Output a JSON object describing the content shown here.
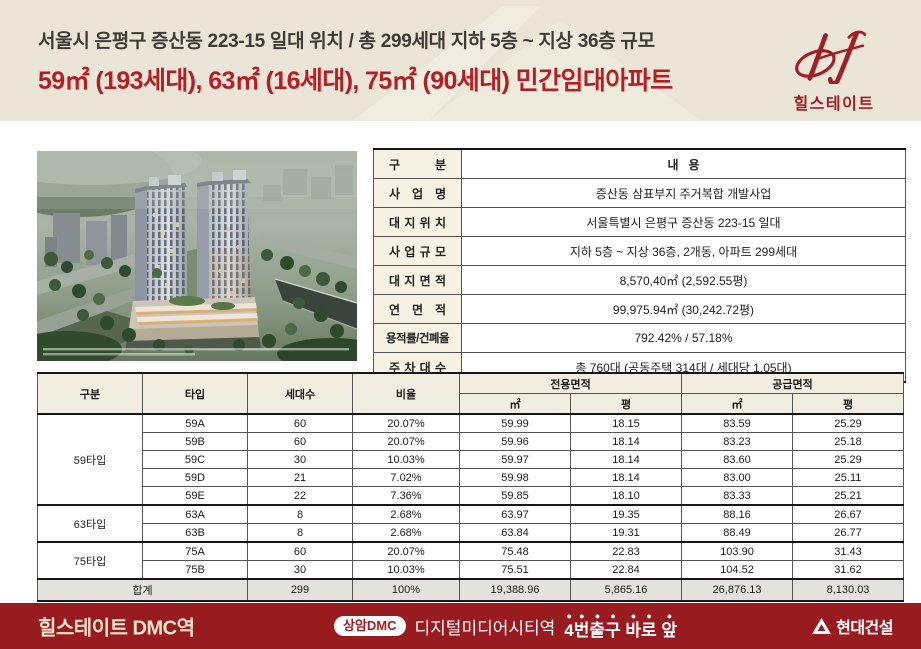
{
  "header": {
    "line1": "서울시 은평구 증산동 223-15 일대 위치 / 총 299세대 지하 5층 ~ 지상 36층 규모",
    "line2": "59㎡ (193세대), 63㎡ (16세대), 75㎡ (90세대) 민간임대아파트",
    "bg_color": "#eae5d6",
    "accent_color": "#b21f24"
  },
  "logo": {
    "brand": "힐스테이트",
    "color": "#9e2025"
  },
  "info_table": {
    "header_label": "구 분",
    "header_value": "내   용",
    "rows": [
      {
        "label": "사 업 명",
        "value": "증산동 삼표부지 주거복합 개발사업"
      },
      {
        "label": "대 지 위 치",
        "value": "서울특별시 은평구 증산동 223-15 일대"
      },
      {
        "label": "사 업 규 모",
        "value": "지하 5층 ~ 지상 36층, 2개동, 아파트 299세대"
      },
      {
        "label": "대 지 면 적",
        "value": "8,570,40㎡ (2,592.55평)"
      },
      {
        "label": "연 면 적",
        "value": "99,975.94㎡ (30,242.72평)"
      },
      {
        "label": "용적률/건폐율",
        "value": "792.42% / 57.18%"
      },
      {
        "label": "주 차 대 수",
        "value": "총 760대 (공동주택 314대 / 세대당 1.05대)"
      }
    ]
  },
  "unit_table": {
    "headers": {
      "group": "구분",
      "type": "타입",
      "households": "세대수",
      "ratio": "비율",
      "exclusive_area": "전용면적",
      "supply_area": "공급면적",
      "sqm": "㎡",
      "pyeong": "평"
    },
    "groups": [
      {
        "name": "59타입",
        "rows": [
          {
            "type": "59A",
            "households": "60",
            "ratio": "20.07%",
            "ex_sqm": "59.99",
            "ex_py": "18.15",
            "su_sqm": "83.59",
            "su_py": "25.29"
          },
          {
            "type": "59B",
            "households": "60",
            "ratio": "20.07%",
            "ex_sqm": "59.96",
            "ex_py": "18.14",
            "su_sqm": "83.23",
            "su_py": "25.18"
          },
          {
            "type": "59C",
            "households": "30",
            "ratio": "10.03%",
            "ex_sqm": "59.97",
            "ex_py": "18.14",
            "su_sqm": "83.60",
            "su_py": "25.29"
          },
          {
            "type": "59D",
            "households": "21",
            "ratio": "7.02%",
            "ex_sqm": "59.98",
            "ex_py": "18.14",
            "su_sqm": "83.00",
            "su_py": "25.11"
          },
          {
            "type": "59E",
            "households": "22",
            "ratio": "7.36%",
            "ex_sqm": "59.85",
            "ex_py": "18.10",
            "su_sqm": "83.33",
            "su_py": "25.21"
          }
        ]
      },
      {
        "name": "63타입",
        "rows": [
          {
            "type": "63A",
            "households": "8",
            "ratio": "2.68%",
            "ex_sqm": "63.97",
            "ex_py": "19.35",
            "su_sqm": "88.16",
            "su_py": "26.67"
          },
          {
            "type": "63B",
            "households": "8",
            "ratio": "2.68%",
            "ex_sqm": "63.84",
            "ex_py": "19.31",
            "su_sqm": "88.49",
            "su_py": "26.77"
          }
        ]
      },
      {
        "name": "75타입",
        "rows": [
          {
            "type": "75A",
            "households": "60",
            "ratio": "20.07%",
            "ex_sqm": "75.48",
            "ex_py": "22.83",
            "su_sqm": "103.90",
            "su_py": "31.43"
          },
          {
            "type": "75B",
            "households": "30",
            "ratio": "10.03%",
            "ex_sqm": "75.51",
            "ex_py": "22.84",
            "su_sqm": "104.52",
            "su_py": "31.62"
          }
        ]
      }
    ],
    "total": {
      "label": "합계",
      "households": "299",
      "ratio": "100%",
      "ex_sqm": "19,388.96",
      "ex_py": "5,865.16",
      "su_sqm": "26,876.13",
      "su_py": "8,130.03"
    }
  },
  "footer": {
    "title": "힐스테이트 DMC역",
    "badge": "상암DMC",
    "station": "디지털미디어시티역",
    "exit_text": "4번출구 바로 앞",
    "builder": "현대건설",
    "bg_color": "#981b20"
  }
}
